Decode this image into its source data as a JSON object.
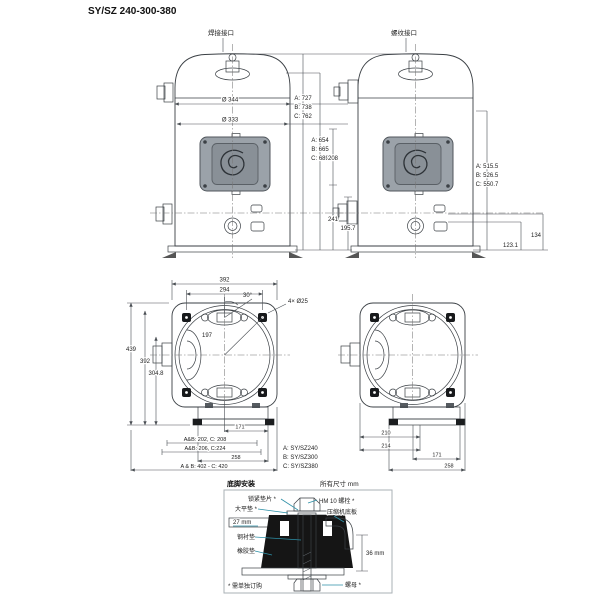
{
  "title": "SY/SZ 240-300-380",
  "colors": {
    "shell_blue": "#cfe9f6",
    "panel_gray": "#9aa1a8",
    "leader_teal": "#2d8fa6"
  },
  "front_views": {
    "welded_port_label": "焊接接口",
    "threaded_port_label": "螺纹接口",
    "left": {
      "dia_outer": "Ø 344",
      "dia_inner": "Ø 333",
      "total_height": [
        "A: 727",
        "B: 738",
        "C: 762"
      ],
      "mid_height": [
        "A: 654",
        "B: 665",
        "C: 689"
      ],
      "dim_port_span": "208",
      "dim_lower": "241",
      "dim_base": "195.7"
    },
    "right": {
      "suction_height": [
        "A: 515.5",
        "B: 526.5",
        "C: 550.7"
      ],
      "dim_lower": "134",
      "dim_base": "123.1"
    }
  },
  "top_views": {
    "left": {
      "width_outer": "392",
      "width_bolts": "294",
      "angle": "30°",
      "holes": "4× Ø25",
      "radius": "197",
      "height_total": "439",
      "height_bolts": "392",
      "height_center": "304.8",
      "foot_171": "171",
      "foot_line1": "A&B: 202, C: 208",
      "foot_line2": "A&B: 206, C:224",
      "foot_258": "258",
      "foot_total": "A & B: 402 - C: 420"
    },
    "legend": [
      "A: SY/SZ240",
      "B: SY/SZ300",
      "C: SY/SZ380"
    ],
    "right": {
      "foot_210": "210",
      "foot_214": "214",
      "foot_171": "171",
      "foot_258": "258"
    }
  },
  "mounting_detail": {
    "section_title": "底脚安装",
    "units_note": "所有尺寸 mm",
    "lock_washer": "锁紧垫片 *",
    "bolt": "HM 10 螺栓 *",
    "flat_washer": "大平垫 *",
    "base_plate": "压缩机底板",
    "plate_thickness": "27 mm",
    "steel_sleeve": "钢衬垫",
    "rubber_grommet": "橡胶垫",
    "height": "36 mm",
    "nut": "螺母 *",
    "footnote": "* 需单独订购"
  }
}
